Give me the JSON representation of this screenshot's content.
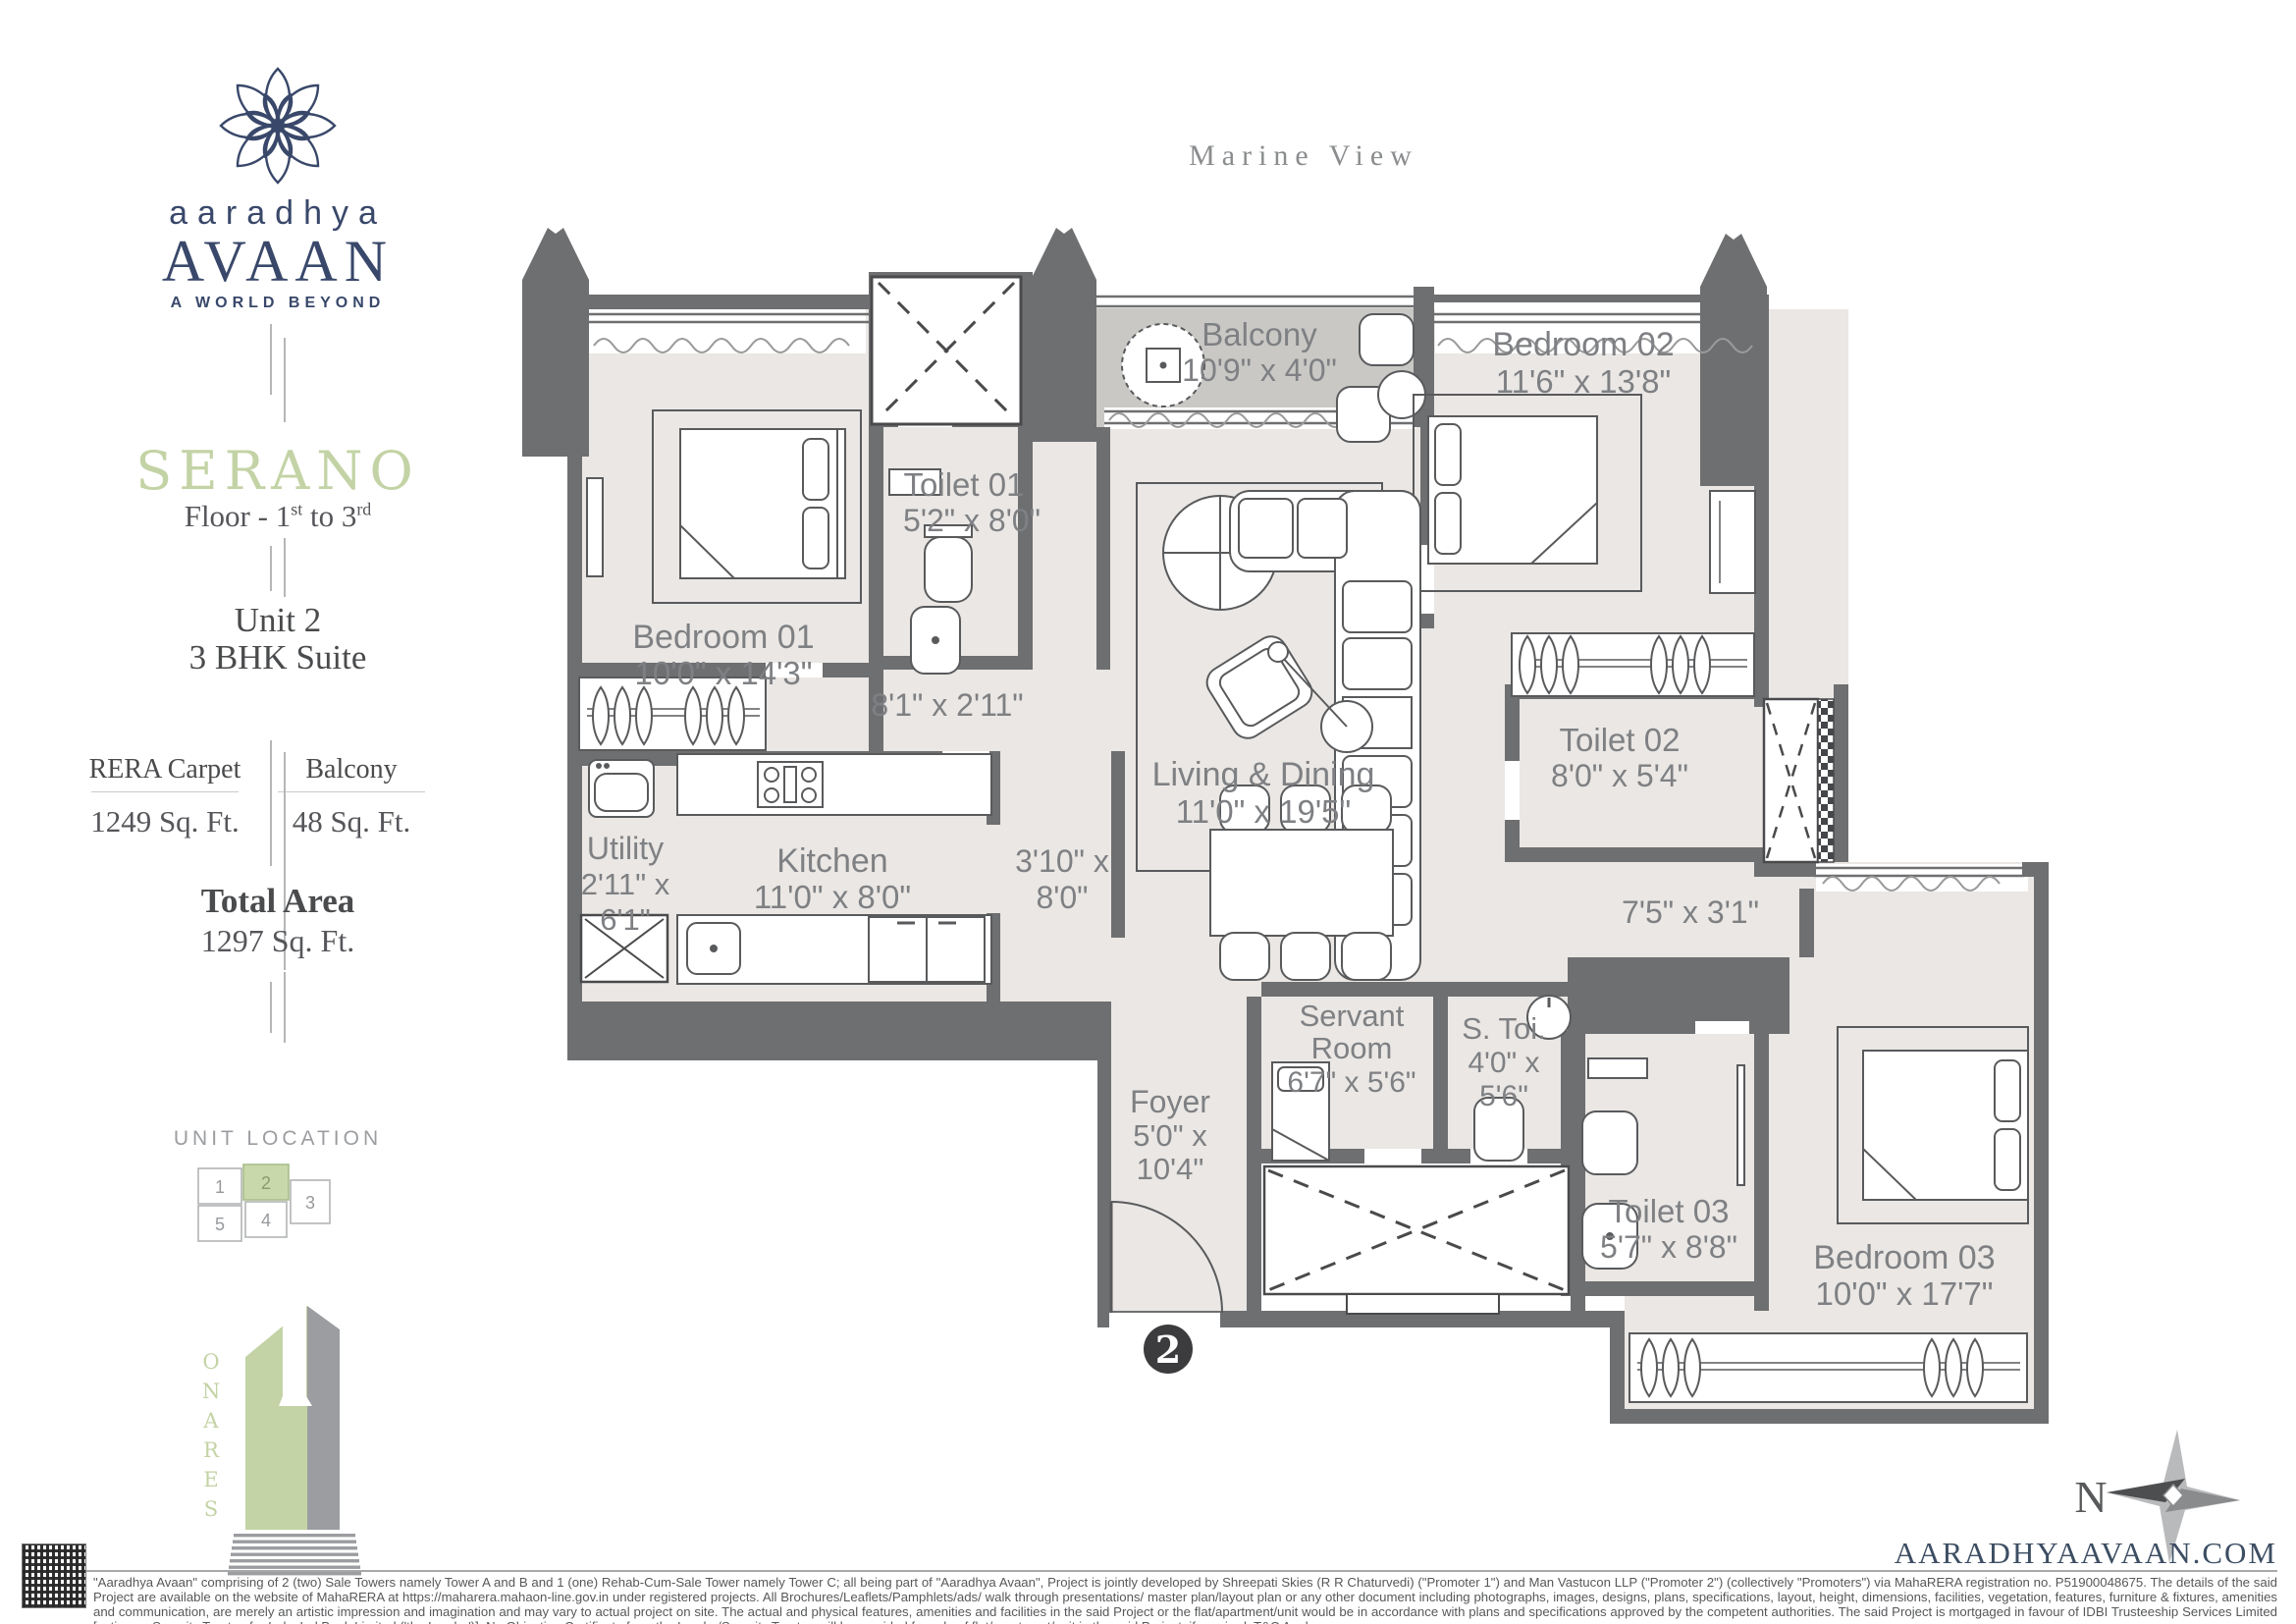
{
  "brand": {
    "name_script": "aaradhya",
    "name_display": "AVAAN",
    "tagline": "A WORLD BEYOND"
  },
  "sidebar": {
    "project_name": "SERANO",
    "floor_label": {
      "prefix": "Floor - 1",
      "sup1": "st",
      "middle": " to 3",
      "sup2": "rd"
    },
    "unit_label": "Unit 2",
    "unit_type": "3 BHK Suite",
    "areas": {
      "rera_carpet": {
        "label": "RERA Carpet",
        "value": "1249 Sq. Ft."
      },
      "balcony": {
        "label": "Balcony",
        "value": "48 Sq. Ft."
      },
      "total": {
        "label": "Total Area",
        "value": "1297 Sq. Ft."
      }
    },
    "unit_location": {
      "label": "UNIT LOCATION",
      "units": [
        "1",
        "2",
        "3",
        "4",
        "5"
      ],
      "highlighted_unit": "2"
    },
    "tower_label": "SERANO"
  },
  "plan": {
    "view_label": "Marine View",
    "unit_marker": "2",
    "compass_label": "N",
    "rooms": {
      "balcony": {
        "lines": [
          "Balcony",
          "10'9\" x 4'0\""
        ]
      },
      "bedroom02": {
        "lines": [
          "Bedroom 02",
          "11'6\" x 13'8\""
        ]
      },
      "toilet01": {
        "lines": [
          "Toilet 01",
          "5'2\" x 8'0\""
        ]
      },
      "bedroom01": {
        "lines": [
          "Bedroom 01",
          "10'0\" x 14'3\""
        ]
      },
      "living": {
        "lines": [
          "Living & Dining",
          "11'0\" x 19'5\""
        ]
      },
      "toilet02": {
        "lines": [
          "Toilet 02",
          "8'0\" x 5'4\""
        ]
      },
      "utility": {
        "lines": [
          "Utility",
          "2'11\" x",
          "6'1\""
        ]
      },
      "kitchen": {
        "lines": [
          "Kitchen",
          "11'0\" x 8'0\""
        ]
      },
      "servant": {
        "lines": [
          "Servant",
          "Room",
          "6'7\" x 5'6\""
        ]
      },
      "s_toi": {
        "lines": [
          "S. Toi.",
          "4'0\" x",
          "5'6\""
        ]
      },
      "foyer": {
        "lines": [
          "Foyer",
          "5'0\" x",
          "10'4\""
        ]
      },
      "toilet03": {
        "lines": [
          "Toilet 03",
          "5'7\" x 8'8\""
        ]
      },
      "bedroom03": {
        "lines": [
          "Bedroom 03",
          "10'0\" x 17'7\""
        ]
      }
    },
    "passages": {
      "corridor": {
        "lines": [
          "8'1\" x 2'11\""
        ]
      },
      "kitchen_side": {
        "lines": [
          "3'10\" x",
          "8'0\""
        ]
      },
      "bedroom03_side": {
        "lines": [
          "7'5\" x 3'1\""
        ]
      }
    }
  },
  "footer": {
    "website": "AARADHYAAVAAN.COM",
    "disclaimer": "\"Aaradhya Avaan\" comprising of 2 (two) Sale Towers namely Tower A and B and 1 (one) Rehab-Cum-Sale Tower namely Tower C; all being part of \"Aaradhya Avaan\", Project is jointly developed by Shreepati Skies (R R Chaturvedi) (\"Promoter 1\") and Man Vastucon LLP (\"Promoter 2\") (collectively \"Promoters\") via MahaRERA registration no. P51900048675. The details of the said Project are available on the website of MahaRERA at https://maharera.mahaon-line.gov.in under registered projects. All Brochures/Leaflets/Pamphlets/ads/ walk through presentations/ master plan/layout plan or any other document including photographs, images, designs, plans, specifications, layout, height, dimensions, facilities, vegetation, features, furniture & fixtures, amenities and communication, are merely an artistic impression and imagination and may vary to actual project on site. The actual and physical features, amenities and facilities in the said Project or the flat/apartment/unit would be in accordance with plans and specifications approved by the competent authorities. The said Project is mortgaged in favour of IDBI Trusteeship Services Limited [acting as Security Trustee for IndusInd Bank Limited ('the Lender')]. No Objection Certificate from the Lender/Security Trustee will be provided for sale of flat/apartment/unit in the said Project, if required. T&C Apply."
  },
  "colors": {
    "brand_navy": "#39486a",
    "accent_green": "#c3d3a5",
    "keyplan_green": "#c9d8ab",
    "wall_gray": "#6e6f71",
    "floor_gray": "#eae7e4",
    "balcony_gray": "#c9c8c5",
    "label_gray": "#7e8083"
  }
}
